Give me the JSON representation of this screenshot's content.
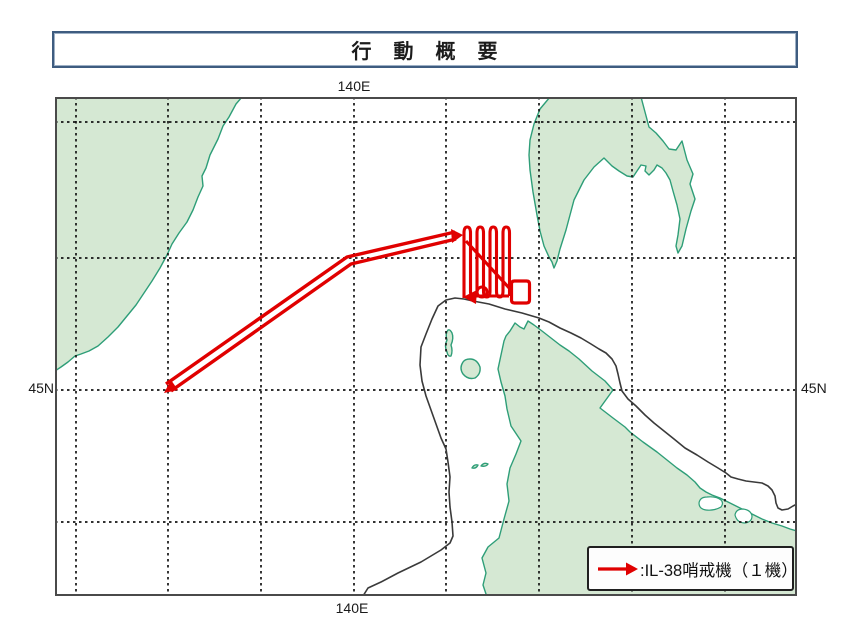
{
  "title": "行　動　概　要",
  "map": {
    "coordinate_labels": {
      "top_longitude": "140E",
      "bottom_longitude": "140E",
      "left_latitude": "45N",
      "right_latitude": "45N"
    },
    "legend": {
      "symbol": "red-flight-track-arrow",
      "label": ":IL-38哨戒機（１機）"
    },
    "colors": {
      "land_fill": "#d5e8d3",
      "coast_stroke": "#2e9e78",
      "track": "#e00000",
      "boundary_line": "#3a3a3a",
      "grid_line": "#141414",
      "map_border": "#4a4a4a",
      "title_border": "#3e5c80"
    },
    "grid": {
      "vertical_x": [
        76,
        168,
        261,
        354,
        446,
        539,
        632,
        725
      ],
      "horizontal_y": [
        122,
        258,
        390,
        522
      ],
      "extent": {
        "x1": 55,
        "y1": 97,
        "x2": 797,
        "y2": 596
      }
    },
    "geometry": {
      "left_landmass": "M 55 97 L 242 97 L 236 104 L 229 117 L 223 126 L 218 139 L 210 155 L 206 168 L 202 176 L 203 186 L 198 197 L 193 210 L 187 222 L 179 233 L 172 244 L 167 255 L 160 268 L 152 281 L 144 293 L 136 305 L 127 316 L 118 327 L 108 337 L 98 346 L 89 351 L 81 354 L 75 356 L 68 362 L 61 367 L 55 371 Z",
      "sakhalin": "M 550 97 L 545 103 L 540 109 L 534 124 L 530 140 L 529 155 L 530 170 L 533 192 L 537 215 L 540 231 L 544 246 L 549 257 L 552 262 L 554 268 L 557 261 L 560 249 L 566 230 L 574 200 L 584 180 L 594 167 L 604 158 L 612 166 L 619 171 L 627 176 L 633 177 L 637 171 L 641 165 L 646 166 L 645 171 L 649 175 L 654 170 L 657 165 L 662 168 L 666 173 L 670 180 L 673 191 L 677 205 L 680 219 L 678 235 L 676 246 L 678 253 L 682 246 L 686 229 L 691 211 L 695 199 L 690 184 L 693 174 L 687 160 L 682 141 L 676 150 L 669 149 L 663 141 L 656 133 L 649 127 L 645 112 L 641 97 Z",
      "hokkaido": "M 487 597 L 483 585 L 486 573 L 482 558 L 488 547 L 499 538 L 504 519 L 509 501 L 507 484 L 510 468 L 516 454 L 521 441 L 511 426 L 507 409 L 505 396 L 501 382 L 498 369 L 501 355 L 504 341 L 506 336 L 510 331 L 515 323 L 520 327 L 524 329 L 528 321 L 534 325 L 542 331 L 551 338 L 560 345 L 569 351 L 579 359 L 592 371 L 605 381 L 613 390 L 600 408 L 613 418 L 625 427 L 630 432 L 643 442 L 657 452 L 667 460 L 677 468 L 687 475 L 695 482 L 700 488 L 706 492 L 712 495 L 720 498 L 728 502 L 736 506 L 744 510 L 752 514 L 762 519 L 772 523 L 782 526 L 790 529 L 797 531 L 797 597 Z",
      "island_rishiri": "M 448 330 Q 445 334 447 340 Q 444 346 447 352 Q 448 357 451 356 Q 453 351 451 345 Q 454 338 452 333 Q 450 329 448 330 Z",
      "island_rebun": "M 463 362 Q 459 368 463 374 Q 468 380 475 378 Q 481 374 480 367 Q 477 359 470 359 Q 465 359 463 362 Z",
      "islet_1": "M 472 468 Q 474 464 478 465 Q 476 469 472 468 Z",
      "islet_2": "M 481 466 Q 484 462 488 464 Q 486 467 481 466 Z",
      "lake_1": "M 699 503 Q 700 497 707 497 Q 716 496 721 500 Q 724 503 721 507 Q 714 511 706 510 Q 699 509 699 503 Z",
      "lake_2": "M 735 515 Q 736 509 743 509 Q 751 510 752 516 Q 752 522 745 523 Q 737 523 735 515 Z",
      "adiz_line": "M 363 596 L 368 588 L 381 582 L 398 573 L 421 562 L 441 550 L 450 543 L 453 536 L 452 522 L 450 507 L 449 492 L 450 477 L 448 462 L 446 449 L 441 438 L 436 424 L 431 410 L 426 396 L 422 381 L 420 365 L 421 347 L 426 334 L 432 319 L 438 306 L 446 300 L 455 298 L 464 299 L 473 301 L 489 304 L 505 309 L 522 313 L 539 318 L 549 322 L 560 328 L 571 333 L 581 338 L 591 344 L 599 349 L 606 353 L 612 359 L 616 366 L 618 374 L 620 383 L 622 391 L 628 399 L 636 406 L 645 415 L 654 423 L 664 431 L 674 439 L 685 448 L 697 455 L 708 462 L 718 468 L 726 473 L 731 477 L 738 479 L 746 481 L 754 482 L 762 483 L 768 486 L 772 490 L 775 496 L 776 503 L 778 508 L 782 510 L 788 509 L 793 506 L 797 504",
      "track_outbound": "M 166 384 L 347 257 L 455 232",
      "track_return": "M 171 391 L 351 264 L 456 239",
      "survey_comb": "M 464 298 L 464 233 Q 464 227 467.2 227 Q 470.5 227 470.5 233 L 470.5 291 Q 470.5 297 473.7 297 Q 477 297 477 291 L 477 233 Q 477 227 480.2 227 Q 483.5 227 483.5 233 L 483.5 291 Q 483.5 297 486.7 297 Q 490 297 490 291 L 490 233 Q 490 227 493.2 227 Q 496.5 227 496.5 233 L 496.5 291 Q 496.5 297 499.7 297 Q 503 297 503 291 L 503 233 Q 503 227 506.2 227 Q 509.5 227 509.5 233 L 509.5 296",
      "survey_diagonal": "M 466 241 L 511 290",
      "survey_bottom_return": "M 509 296 L 472 296",
      "survey_loop": "M 477 292 A 5 5 0 1 0 487 292 A 5 5 0 1 0 477 292 Z",
      "survey_square": "M 514.5 281 L 526.5 281 Q 529.5 281 529.5 284 L 529.5 300 Q 529.5 303 526.5 303 L 514.5 303 Q 511.5 303 511.5 300 L 511.5 284 Q 511.5 281 514.5 281 Z",
      "arrow_southwest": "164,393 171,380 178,390",
      "arrow_east": "463,235 451,229 452,243",
      "arrow_west": "463,297 477,290 476,304"
    }
  }
}
